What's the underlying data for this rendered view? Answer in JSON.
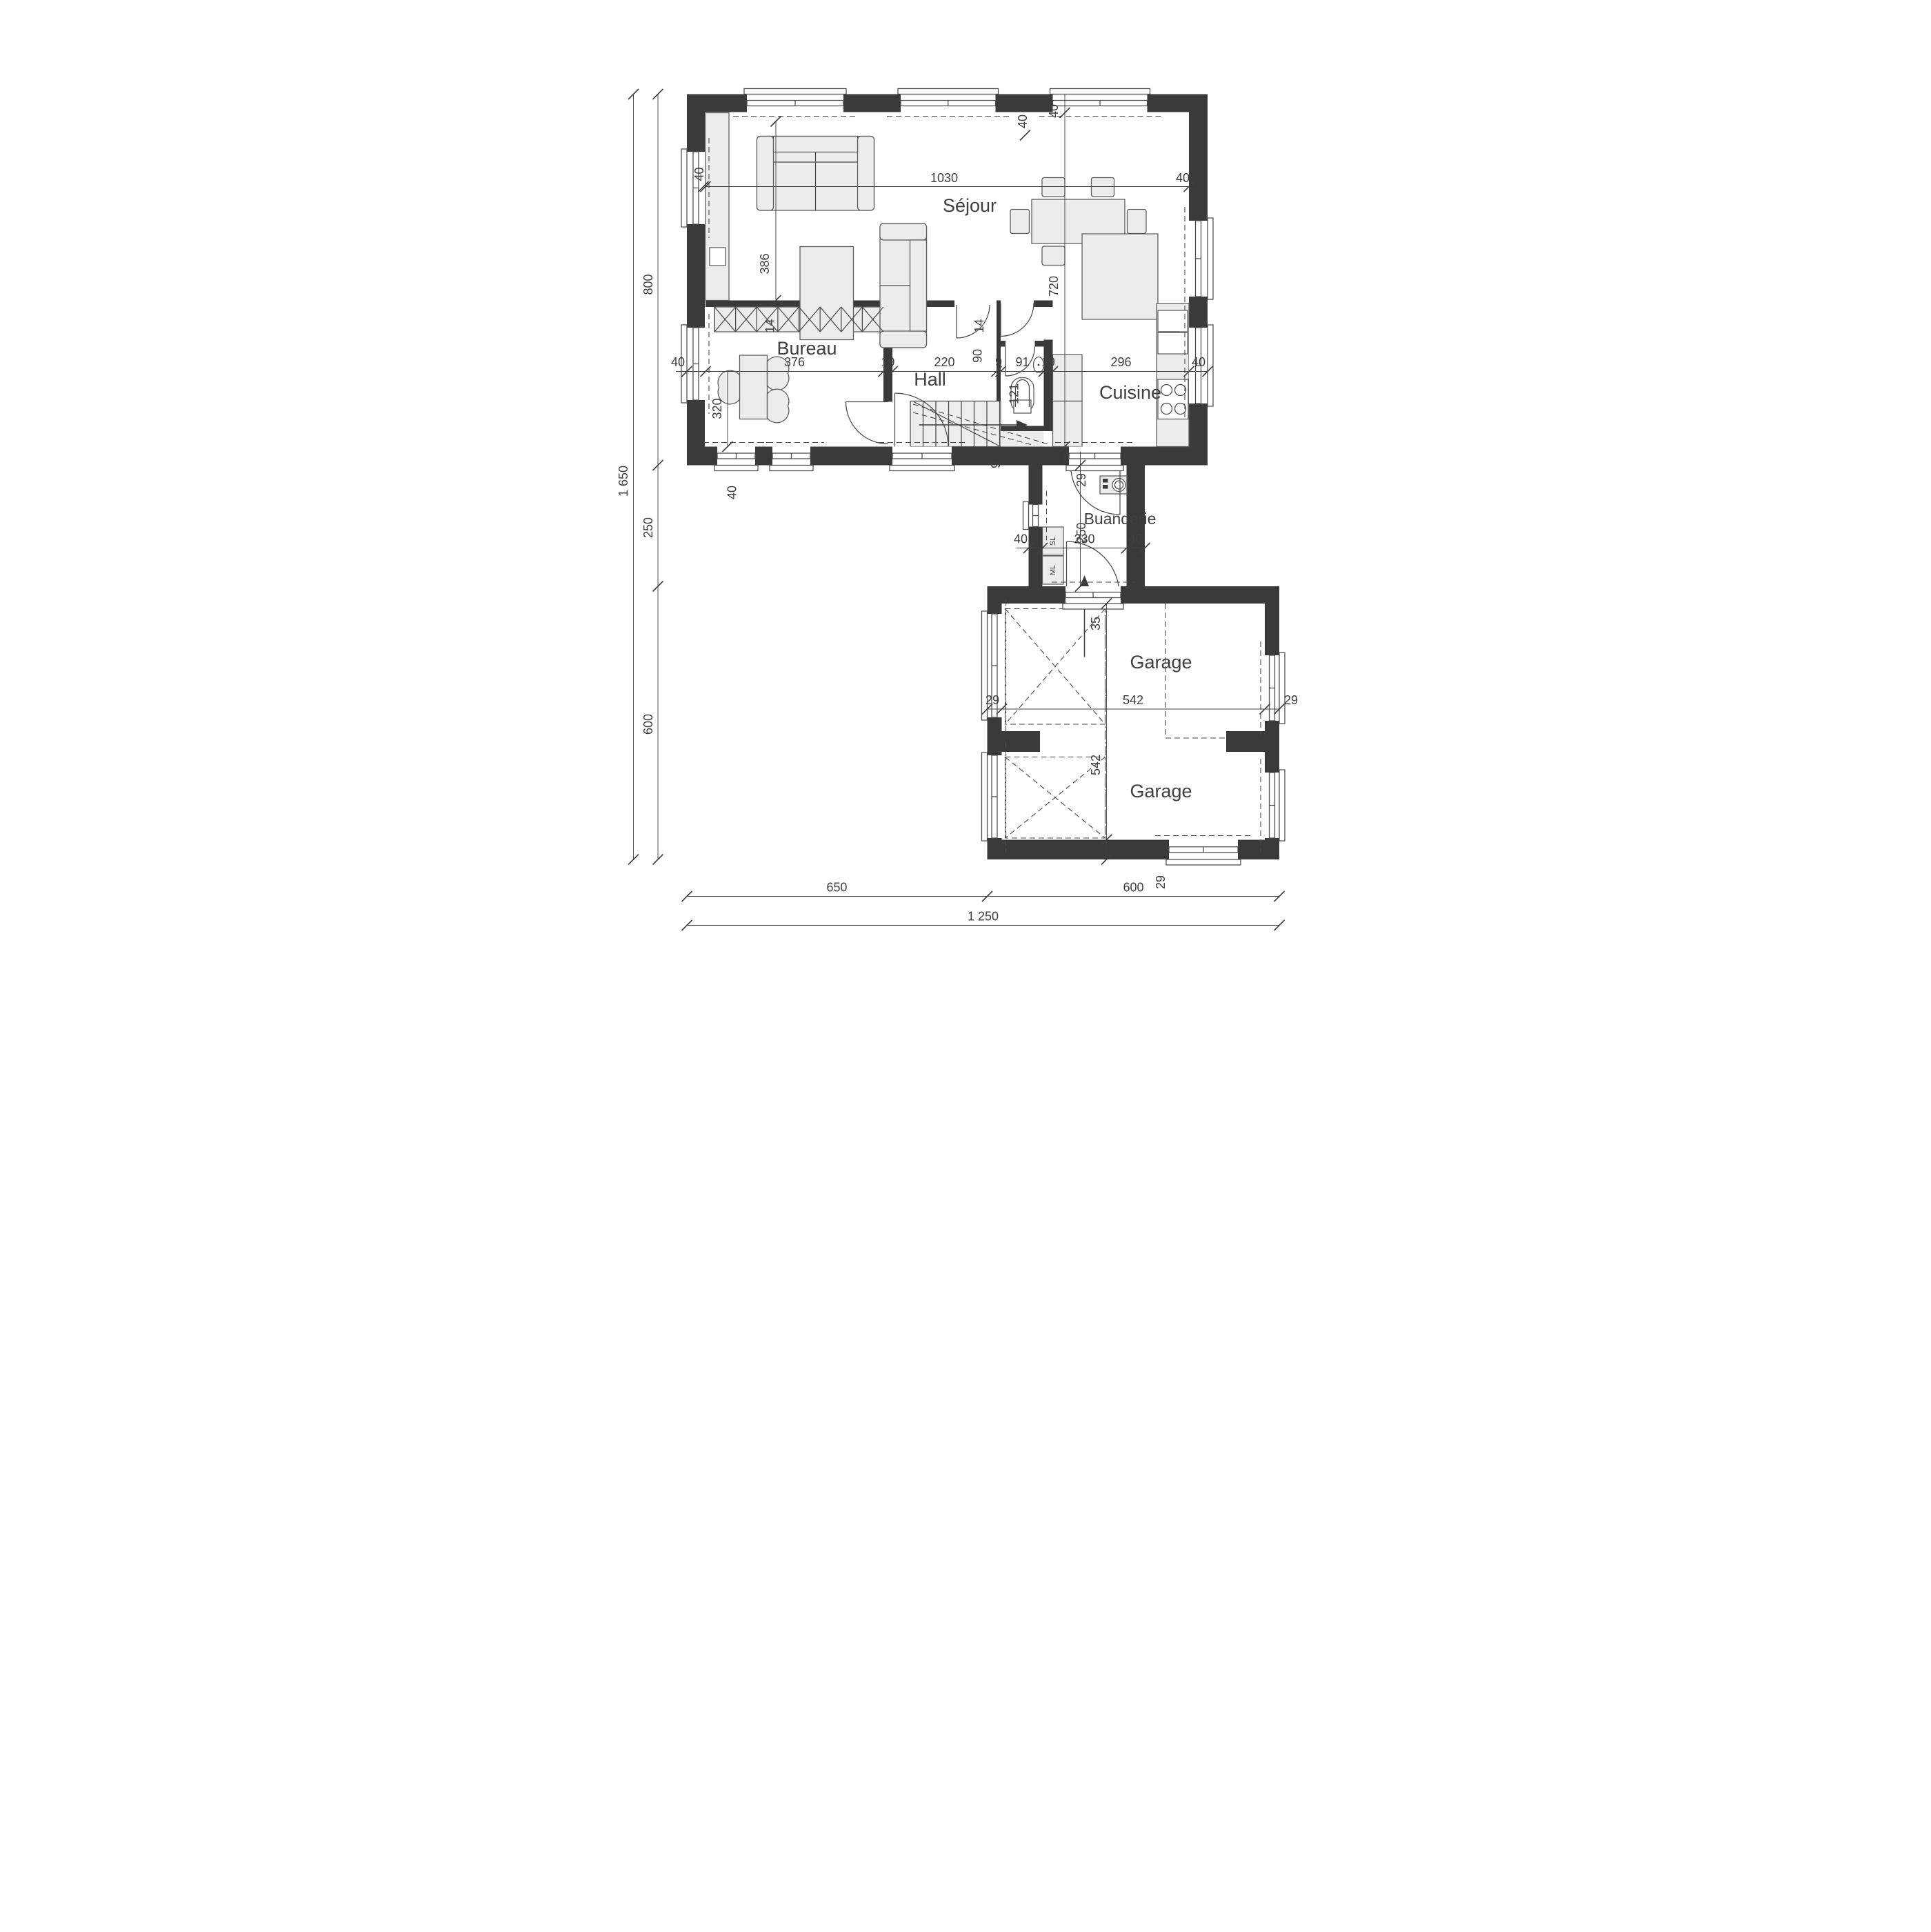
{
  "plan_title": "floor-plan",
  "colors": {
    "wall": "#3a3a3a",
    "line": "#4a4a4a",
    "fill": "#ececec",
    "text": "#3f3f3f"
  },
  "labels": {
    "rooms": {
      "sejour": "Séjour",
      "bureau": "Bureau",
      "hall": "Hall",
      "cuisine": "Cuisine",
      "buanderie": "Buanderie",
      "garage_top": "Garage",
      "garage_bottom": "Garage"
    },
    "appliances": {
      "dryer": "SL",
      "washer": "ML"
    },
    "dims": {
      "top_40_left": "40",
      "top_1030": "1030",
      "top_40_right": "40",
      "top_40_wall": "40",
      "right_40_top": "40",
      "right_720": "720",
      "left_1650": "1 650",
      "left_800": "800",
      "left_250": "250",
      "left_600": "600",
      "mid_40_l": "40",
      "mid_376": "376",
      "mid_19_a": "19",
      "mid_220": "220",
      "mid_9": "9",
      "mid_91": "91",
      "mid_19_b": "19",
      "mid_296": "296",
      "mid_40_r": "40",
      "sejour_386": "386",
      "sejour_14_l": "14",
      "sejour_14_r": "14",
      "bureau_320": "320",
      "bureau_40_btm": "40",
      "wc_90": "90",
      "wc_121": "121",
      "wc_9": "9",
      "bua_29": "29",
      "bua_250": "250",
      "bua_230": "230",
      "bua_40_l": "40",
      "bua_40_r": "40",
      "bua_35": "35",
      "gar_29_l": "29",
      "gar_542_h": "542",
      "gar_29_r": "29",
      "gar_542_v": "542",
      "gar_29_btm": "29",
      "btm_650": "650",
      "btm_600": "600",
      "btm_1250": "1 250"
    }
  }
}
